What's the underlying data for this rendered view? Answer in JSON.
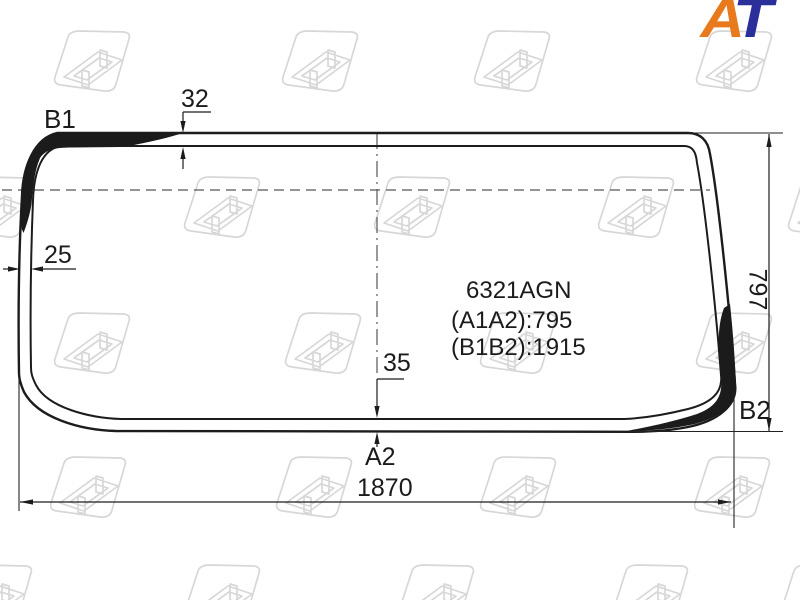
{
  "brand_logo": {
    "letter_a": "A",
    "letter_t": "T"
  },
  "glass": {
    "part_number": "6321AGN",
    "measure_a": "(A1A2):795",
    "measure_b": "(B1B2):1915",
    "point_labels": {
      "top_left": "B1",
      "bottom_right": "B2",
      "bottom_center": "A2"
    },
    "dimensions": {
      "top_band": "32",
      "left_band": "25",
      "bottom_band": "35",
      "overall_width": "1870",
      "overall_height": "797"
    }
  },
  "colors": {
    "line": "#1c1c1c",
    "ceramic_band": "#1b1b1b",
    "dash_line": "#565656",
    "watermark": "#d7d7d7",
    "logo_orange": "#e8791d",
    "logo_blue": "#2b2f9a"
  }
}
